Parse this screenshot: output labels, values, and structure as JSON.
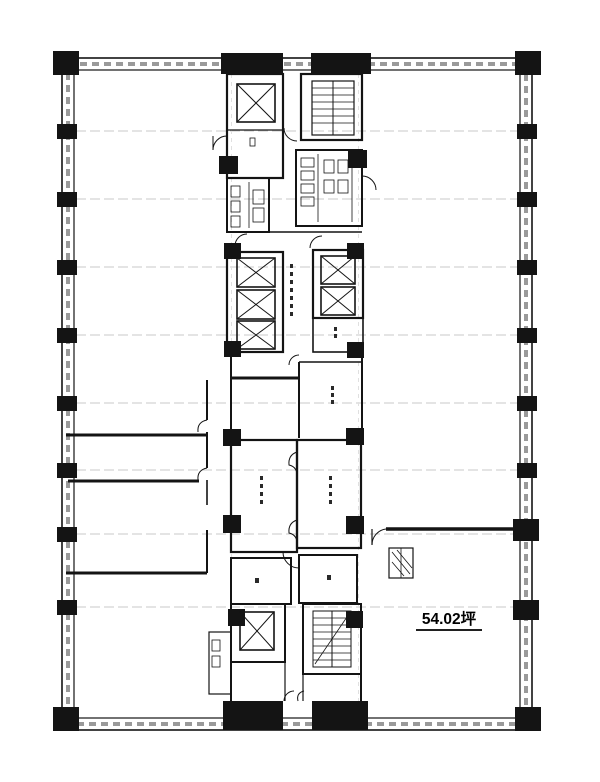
{
  "plan": {
    "area_label": "54.02坪",
    "colors": {
      "ink": "#141414",
      "grid_line": "#c8c8c8",
      "wall_hatch": "#9a9a9a",
      "background": "#ffffff"
    },
    "elements": {
      "upper_left_shaft": "elevator",
      "upper_right_shaft": "staircase",
      "mid_left_bank_elevators": 3,
      "mid_right_bank_elevators": 2,
      "lower_left_shaft": "elevator",
      "lower_right_shaft": "staircase"
    }
  }
}
